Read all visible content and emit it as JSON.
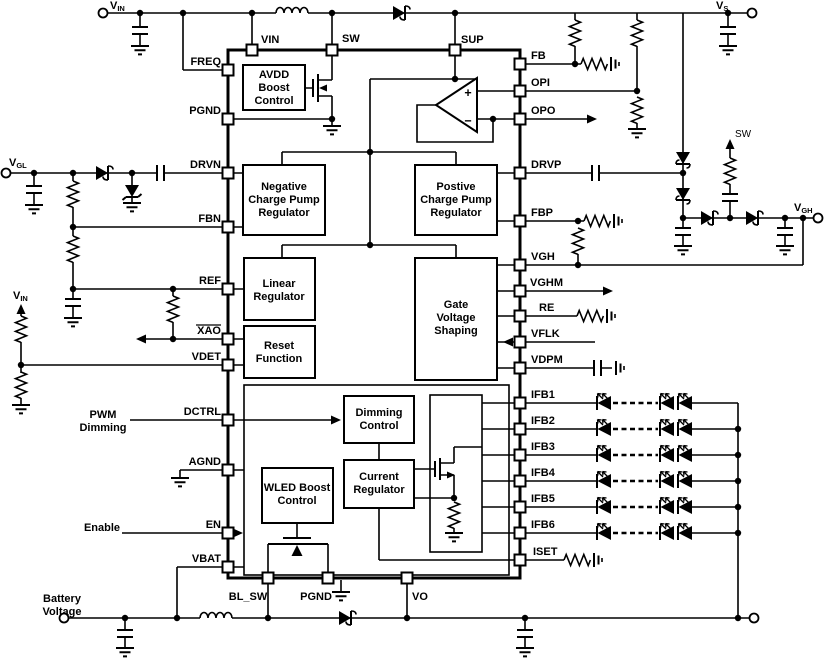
{
  "diagram_type": "IC block diagram schematic",
  "colors": {
    "line": "#000000",
    "background": "#ffffff"
  },
  "ic": {
    "pins": {
      "top": [
        "VIN",
        "SW",
        "SUP"
      ],
      "left": [
        "FREQ",
        "PGND",
        "DRVN",
        "FBN",
        "REF",
        "XAO",
        "VDET",
        "DCTRL",
        "AGND",
        "EN",
        "VBAT"
      ],
      "right": [
        "FB",
        "OPI",
        "OPO",
        "DRVP",
        "FBP",
        "VGH",
        "VGHM",
        "RE",
        "VFLK",
        "VDPM",
        "IFB1",
        "IFB2",
        "IFB3",
        "IFB4",
        "IFB5",
        "IFB6",
        "ISET"
      ],
      "bottom": [
        "BL_SW",
        "PGND",
        "VO"
      ]
    },
    "blocks": {
      "avdd": {
        "lines": [
          "AVDD",
          "Boost",
          "Control"
        ]
      },
      "neg_cp": {
        "lines": [
          "Negative",
          "Charge Pump",
          "Regulator"
        ]
      },
      "pos_cp": {
        "lines": [
          "Postive",
          "Charge Pump",
          "Regulator"
        ]
      },
      "linear": {
        "lines": [
          "Linear",
          "Regulator"
        ]
      },
      "reset": {
        "lines": [
          "Reset",
          "Function"
        ]
      },
      "gvs": {
        "lines": [
          "Gate",
          "Voltage",
          "Shaping"
        ]
      },
      "dimming": {
        "lines": [
          "Dimming",
          "Control"
        ]
      },
      "current": {
        "lines": [
          "Current",
          "Regulator"
        ]
      },
      "wled": {
        "lines": [
          "WLED Boost",
          "Control"
        ]
      }
    },
    "opamp": {
      "plus": "+",
      "minus": "−"
    }
  },
  "labels": {
    "vin_top": {
      "main": "V",
      "sub": "IN"
    },
    "vs": {
      "main": "V",
      "sub": "S"
    },
    "vgl": {
      "main": "V",
      "sub": "GL"
    },
    "vgh": {
      "main": "V",
      "sub": "GH"
    },
    "vin_divider": {
      "main": "V",
      "sub": "IN"
    },
    "sw_net": "SW",
    "pwm": {
      "lines": [
        "PWM",
        "Dimming"
      ]
    },
    "enable": "Enable",
    "battery": {
      "lines": [
        "Battery",
        "Voltage"
      ]
    }
  }
}
